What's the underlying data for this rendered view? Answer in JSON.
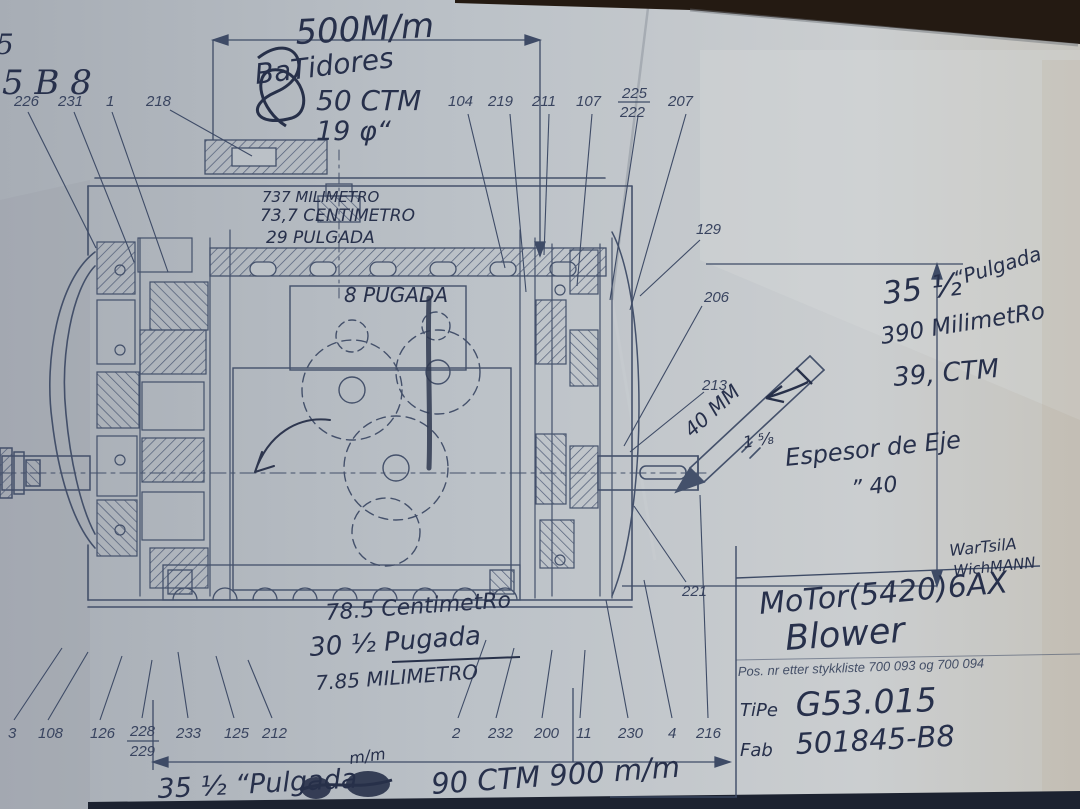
{
  "corner_notes": {
    "fragment": "5",
    "code": "5 B 8"
  },
  "annotations": {
    "dim_top": "500M/m",
    "batidores": "BaTidores",
    "cm_50": "50 CTM",
    "dia_19": "19 φ“",
    "mm_737": "737 MILIMETRO",
    "cm_737": "73,7 CENTIMETRO",
    "in_29": "29 PULGADA",
    "in_8": "8 PUGADA",
    "right_in": "35 ½",
    "right_in_unit": "“Pulgada",
    "right_mm": "390 MilimetRo",
    "right_cm": "39, CTM",
    "shaft_mm": "40 MM",
    "shaft_in": "1 ⅝",
    "espesor": "Espesor de Eje",
    "espesor_val": "” 40",
    "bottom_cm": "78.5 CentimetRo",
    "bottom_in": "30 ½ Pugada",
    "bottom_mm": "7.85 MILIMETRO",
    "bottom_dim_in": "35 ½ “Pulgada",
    "bottom_dim_mm_small": "m/m",
    "bottom_dim": "90 CTM 900 m/m"
  },
  "title_block": {
    "maker_line1": "WarTsilA",
    "maker_line2": "WichMANN",
    "motor": "MoTor(5420)6AX",
    "blower": "Blower",
    "pos_line": "Pos. nr etter stykkliste   700 093 og 700 094",
    "type_label": "TiPe",
    "type_value": "G53.015",
    "fab_label": "Fab",
    "fab_value": "501845-B8"
  },
  "parts": {
    "top": [
      "226",
      "231",
      "1",
      "218",
      "104",
      "219",
      "211",
      "107"
    ],
    "top_stacked": [
      "225",
      "222"
    ],
    "top_last": "207",
    "right": [
      "129",
      "206",
      "213",
      "221"
    ],
    "bottom_left": [
      "3",
      "108",
      "126"
    ],
    "bottom_stacked": [
      "228",
      "229"
    ],
    "bottom_mid": [
      "233",
      "125",
      "212"
    ],
    "bottom_right": [
      "2",
      "232",
      "200",
      "11",
      "230",
      "4",
      "216"
    ]
  },
  "colors": {
    "paper": "#bcc2c8",
    "ink": "#3e4b66",
    "pen": "#273049",
    "table": "#20160e"
  }
}
